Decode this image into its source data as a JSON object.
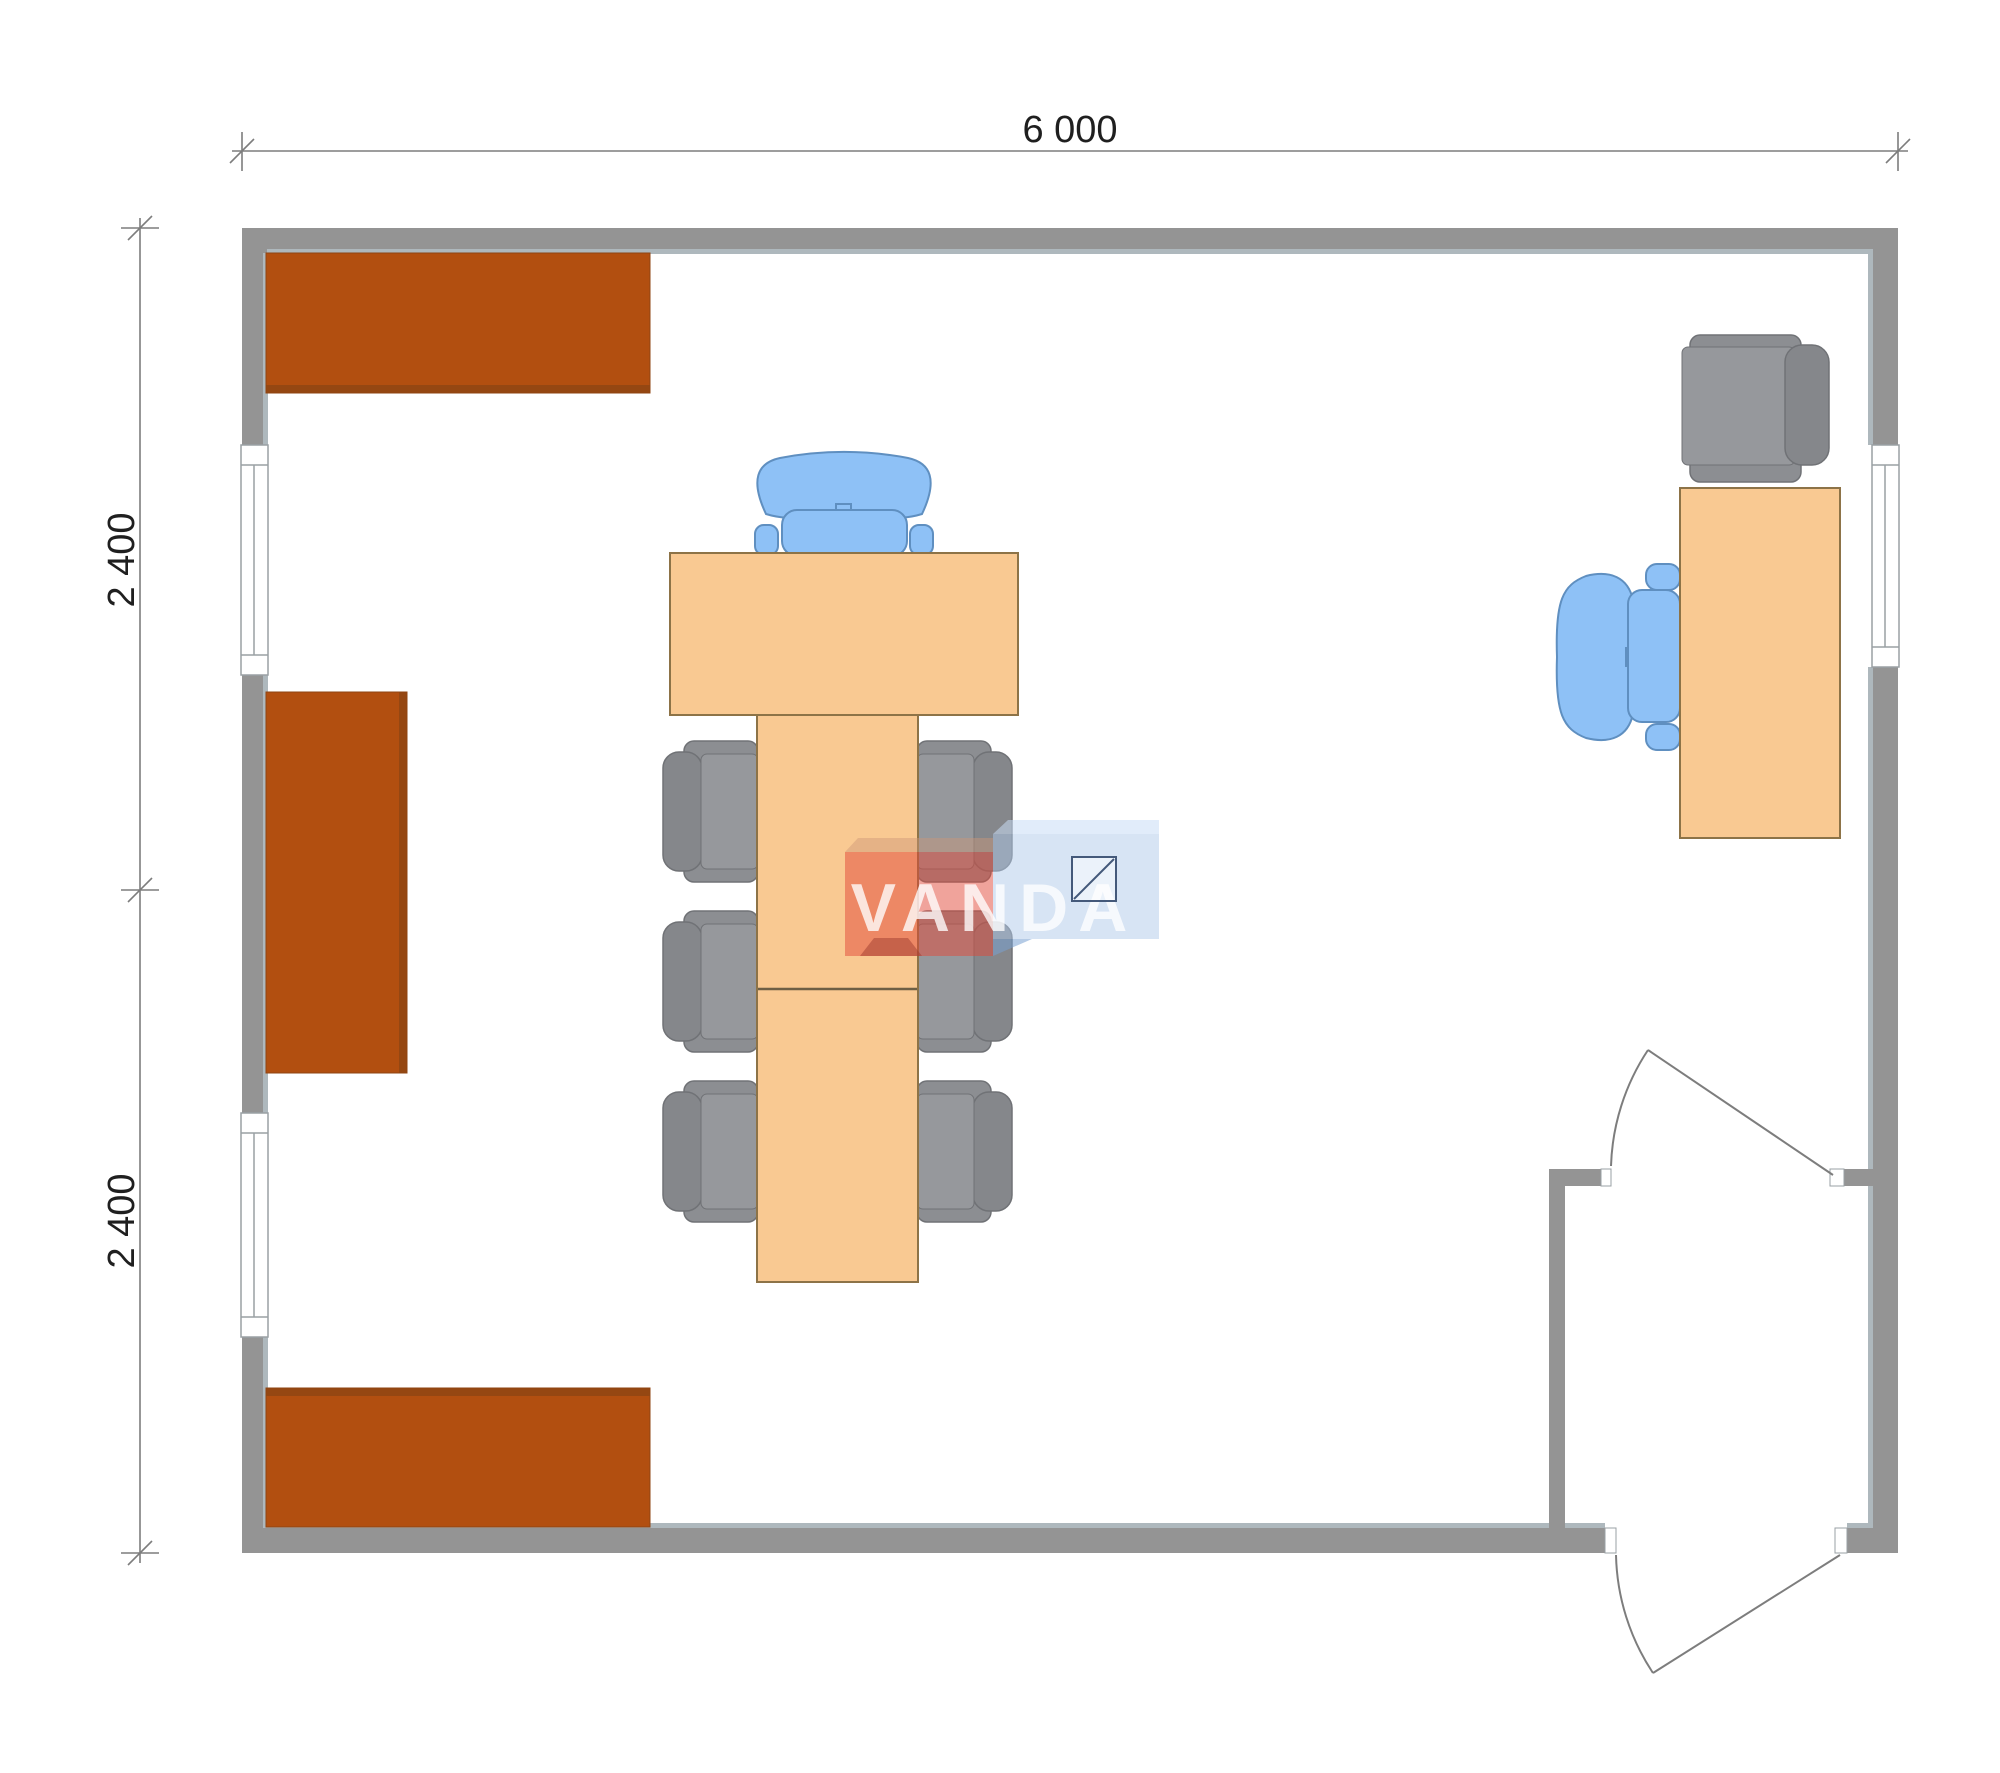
{
  "page": {
    "background": "#ffffff"
  },
  "palette": {
    "wall": "#949494",
    "wall_lining": "#aeb8bd",
    "cabinet": "#b24f10",
    "cabinet_edge": "#8f4513",
    "table_fill": "#f9c992",
    "table_border": "#8d7347",
    "table_seam": "#6e5f45",
    "chair_gray": "#8c8e92",
    "chair_gray_inner": "#96989c",
    "chair_gray_back": "#85878b",
    "chair_gray_border": "#707276",
    "chair_blue": "#8ec1f6",
    "chair_blue_border": "#5f8fc0",
    "line_gray": "#7d7d7d",
    "dim_text": "#1f1f1f",
    "window_border": "#9aa0a4",
    "watermark_red": "rgba(226,71,55,0.5)",
    "watermark_red_bevel": "rgba(205,150,120,0.45)",
    "watermark_red_side": "rgba(160,60,48,0.5)",
    "watermark_blue": "rgba(175,202,233,0.5)",
    "watermark_blue_bevel": "rgba(200,220,245,0.55)",
    "watermark_blue_side": "rgba(120,160,210,0.55)",
    "watermark_text_color": "rgba(255,255,255,0.78)",
    "watermark_icon_stroke": "#44597a"
  },
  "dimensions": {
    "top": {
      "label": "6 000"
    },
    "left_upper": {
      "label": "2 400"
    },
    "left_lower": {
      "label": "2 400"
    }
  },
  "watermark": {
    "text": "VANDA",
    "icon": "square-diagonal-icon"
  }
}
